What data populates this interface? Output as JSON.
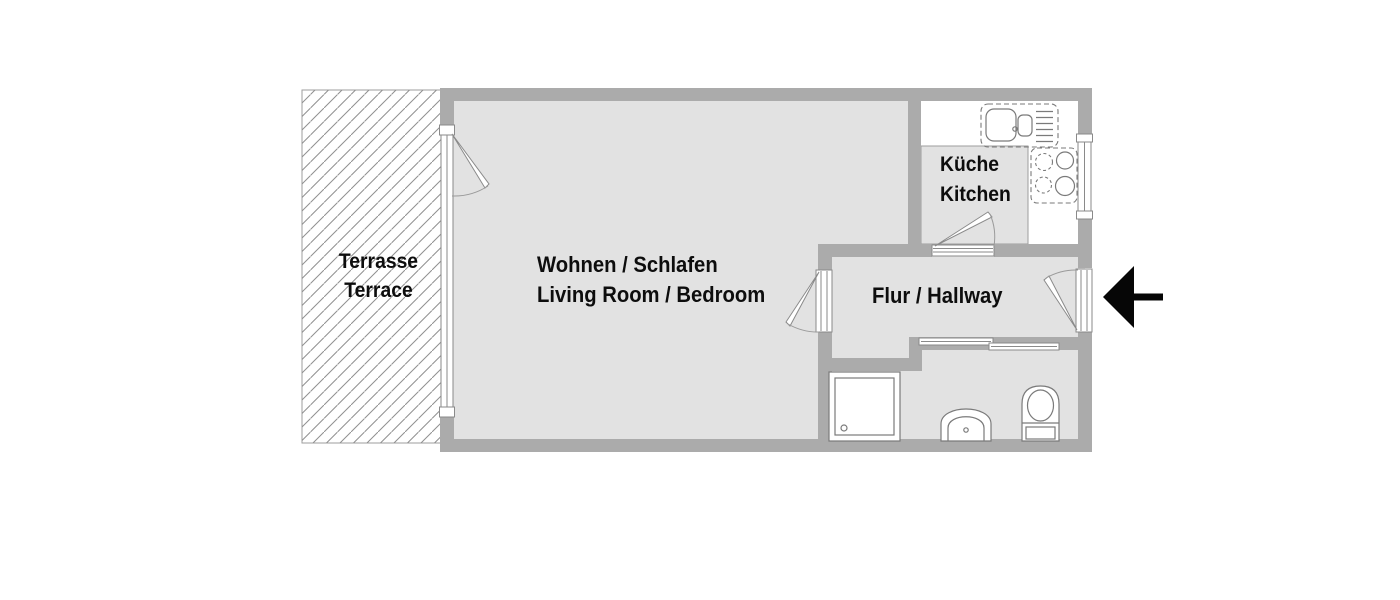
{
  "rooms": {
    "terrace": {
      "line1": "Terrasse",
      "line2": "Terrace"
    },
    "living_bedroom": {
      "line1": "Wohnen / Schlafen",
      "line2": "Living Room / Bedroom"
    },
    "kitchen": {
      "line1": "Küche",
      "line2": "Kitchen"
    },
    "hallway": {
      "line1": "Flur / Hallway"
    }
  },
  "fixtures": [
    "kitchen-sink",
    "cooktop",
    "shower",
    "washbasin",
    "toilet"
  ],
  "symbols": {
    "entrance_arrow_direction": "left",
    "terrace_fill": "diagonal-hatch"
  },
  "colors": {
    "wall": "#ababab",
    "floor": "#e2e2e2",
    "outline": "#8a8a8a",
    "fixture_line": "#7a7a7a",
    "hatch": "#8f8f8f",
    "label_text": "#0d0d0d",
    "arrow": "#060606",
    "background": "#ffffff"
  }
}
